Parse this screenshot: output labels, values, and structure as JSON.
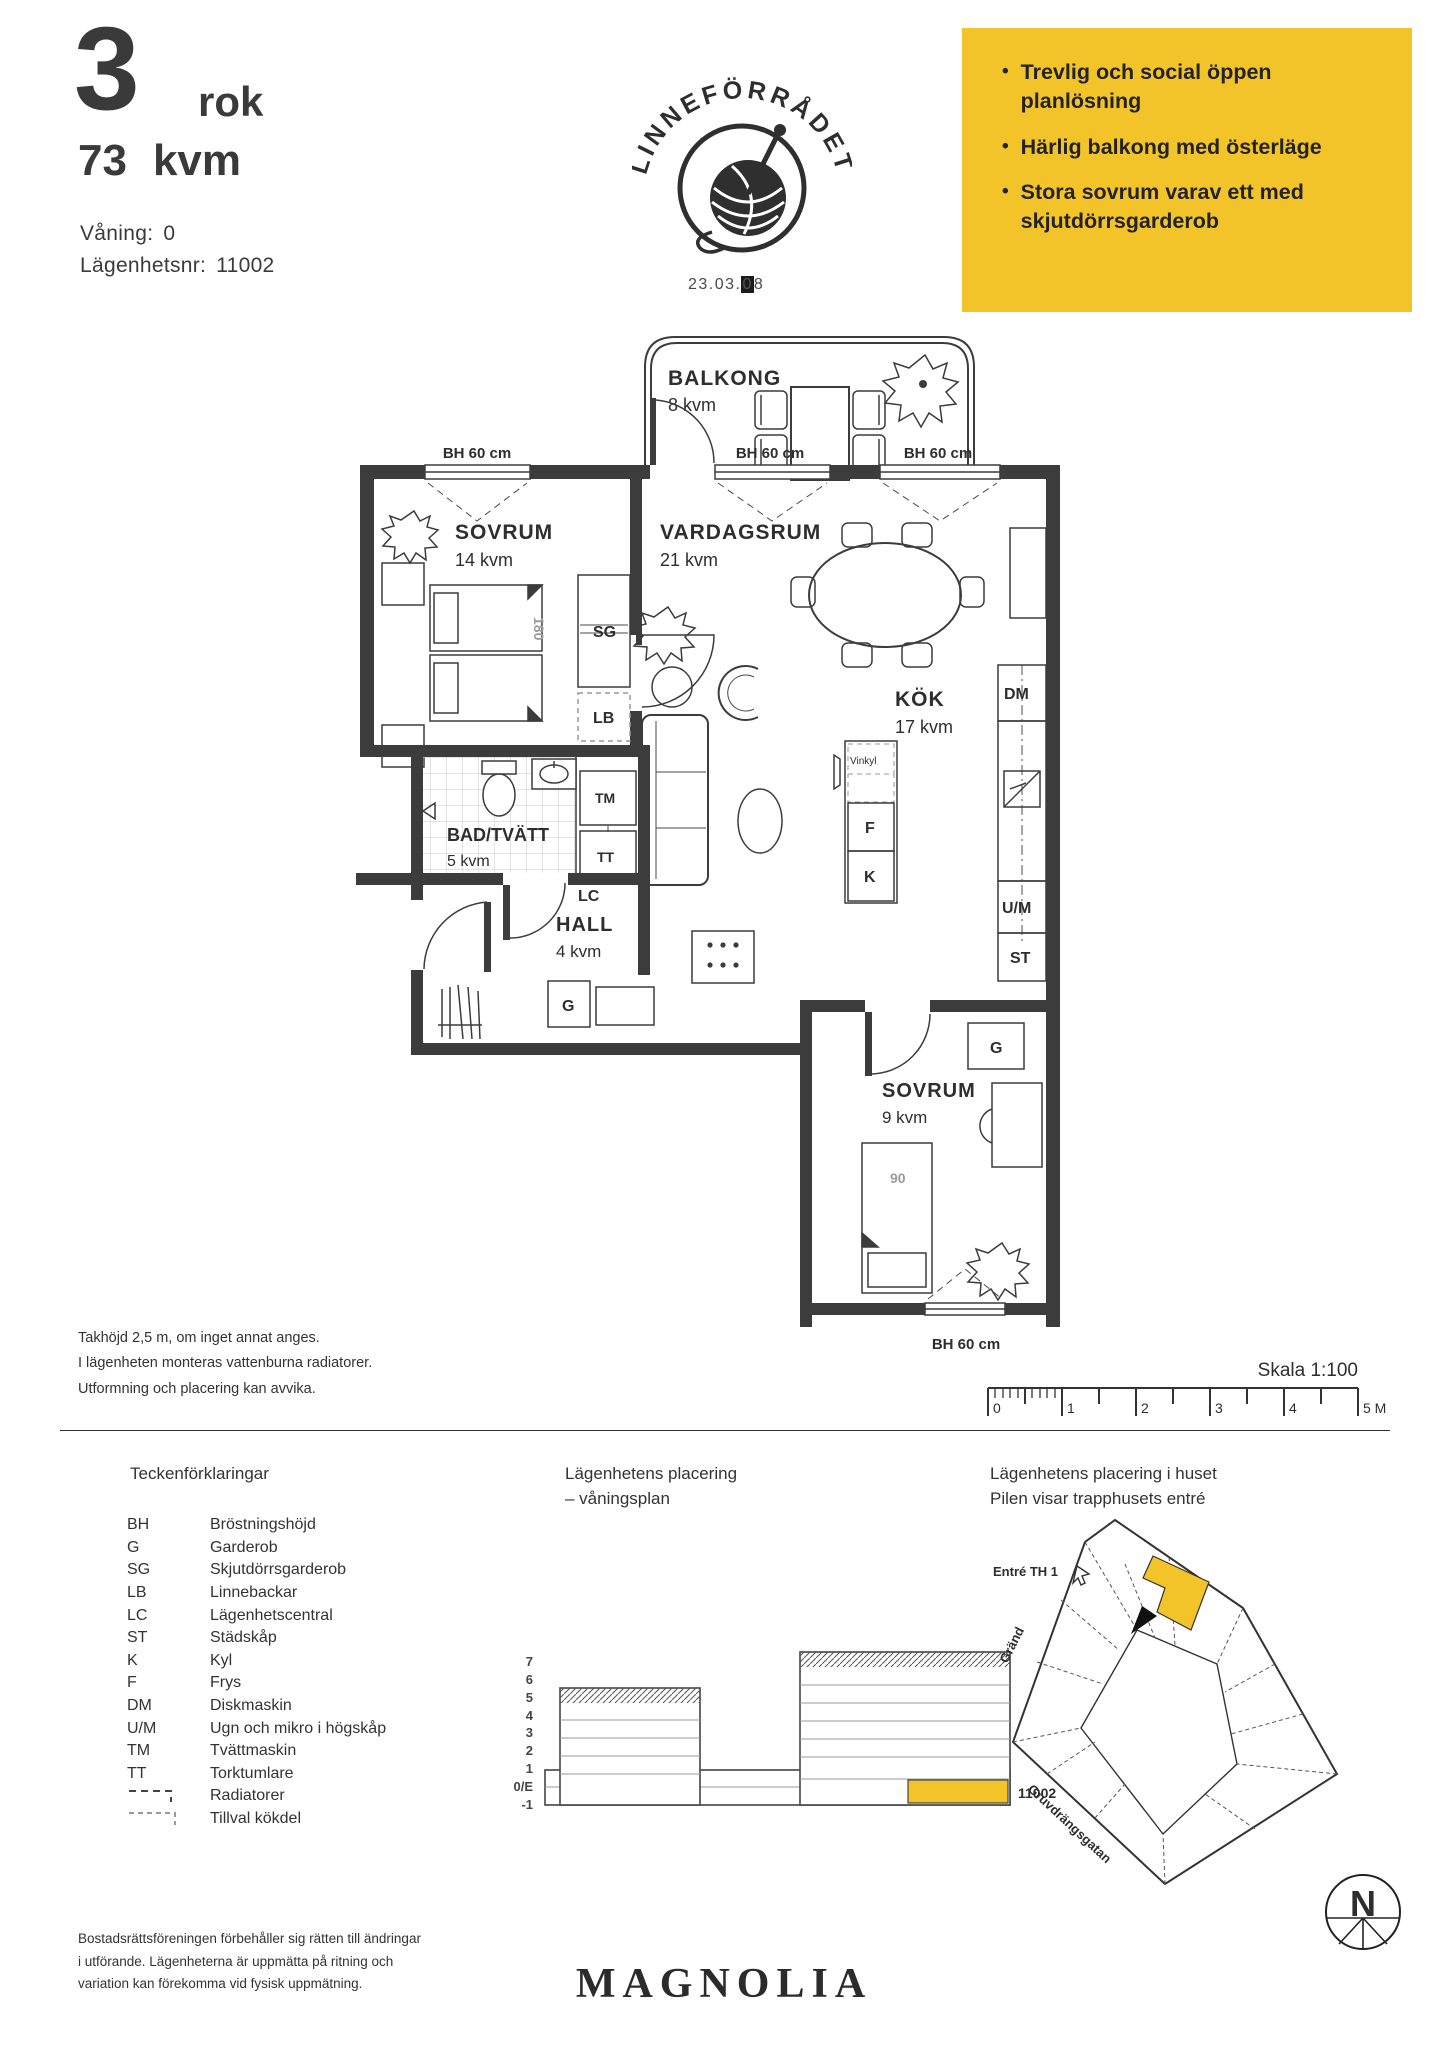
{
  "header": {
    "rooms_number": "3",
    "rooms_unit": "rok",
    "area_value": "73",
    "area_unit": "kvm",
    "floor_label": "Våning:",
    "floor_value": "0",
    "apartment_label": "Lägenhetsnr:",
    "apartment_value": "11002"
  },
  "logo": {
    "brand": "LINNEFÖRRÅDET",
    "date_prefix": "23.03.",
    "date_boxed": "0",
    "date_suffix": "8"
  },
  "highlights": {
    "bullet": "•",
    "bg": "#F3C32A",
    "items": [
      "Trevlig och social öppen planlösning",
      "Härlig balkong med österläge",
      "Stora sovrum varav ett med skjutdörrsgarderob"
    ]
  },
  "floorplan": {
    "balcony_name": "BALKONG",
    "balcony_area": "8 kvm",
    "bedroom1_name": "SOVRUM",
    "bedroom1_area": "14 kvm",
    "living_name": "VARDAGSRUM",
    "living_area": "21 kvm",
    "kitchen_name": "KÖK",
    "kitchen_area": "17 kvm",
    "bath_name": "BAD/TVÄTT",
    "bath_area": "5 kvm",
    "hall_name": "HALL",
    "hall_area": "4 kvm",
    "bedroom2_name": "SOVRUM",
    "bedroom2_area": "9 kvm",
    "window_height_label": "BH 60 cm",
    "bed_double_width": "180",
    "bed_single_width": "90",
    "wardrobe": "G",
    "sliding_wardrobe": "SG",
    "linen": "LB",
    "central": "LC",
    "cleaning": "ST",
    "fridge": "K",
    "freezer": "F",
    "dishwasher": "DM",
    "oven_micro": "U/M",
    "washer": "TM",
    "dryer": "TT",
    "wine_fridge": "Vinkyl"
  },
  "notes": {
    "lines": [
      "Takhöjd 2,5 m, om inget annat anges.",
      "I lägenheten monteras vattenburna radiatorer.",
      "Utformning och placering kan avvika."
    ]
  },
  "scalebar": {
    "title": "Skala 1:100",
    "ticks": [
      "0",
      "1",
      "2",
      "3",
      "4",
      "5 M"
    ]
  },
  "legend": {
    "title": "Teckenförklaringar",
    "items": [
      {
        "abbr": "BH",
        "label": "Bröstningshöjd"
      },
      {
        "abbr": "G",
        "label": "Garderob"
      },
      {
        "abbr": "SG",
        "label": "Skjutdörrsgarderob"
      },
      {
        "abbr": "LB",
        "label": "Linnebackar"
      },
      {
        "abbr": "LC",
        "label": "Lägenhetscentral"
      },
      {
        "abbr": "ST",
        "label": "Städskåp"
      },
      {
        "abbr": "K",
        "label": "Kyl"
      },
      {
        "abbr": "F",
        "label": "Frys"
      },
      {
        "abbr": "DM",
        "label": "Diskmaskin"
      },
      {
        "abbr": "U/M",
        "label": "Ugn och mikro i högskåp"
      },
      {
        "abbr": "TM",
        "label": "Tvättmaskin"
      },
      {
        "abbr": "TT",
        "label": "Torktumlare"
      },
      {
        "abbr": "",
        "label": "Radiatorer"
      },
      {
        "abbr": "",
        "label": "Tillval kökdel"
      }
    ]
  },
  "placement_floor": {
    "title_line1": "Lägenhetens placering",
    "title_line2": "– våningsplan",
    "floors": [
      "7",
      "6",
      "5",
      "4",
      "3",
      "2",
      "1",
      "0/E",
      "-1"
    ],
    "unit": "11002"
  },
  "placement_house": {
    "title_line1": "Lägenhetens placering i huset",
    "title_line2": "Pilen visar trapphusets entré",
    "entrance_label": "Entré TH 1",
    "street_left": "Gränd",
    "street_bottom": "Gruvdrängsgatan",
    "compass_letter": "N"
  },
  "footer": {
    "disclaimer_lines": [
      "Bostadsrättsföreningen förbehåller sig rätten till ändringar",
      "i utförande. Lägenheterna är uppmätta på ritning och",
      "variation kan förekomma vid fysisk uppmätning."
    ],
    "brand": "MAGNOLIA"
  },
  "colors": {
    "accent": "#F3C32A",
    "ink": "#3c3c3c"
  }
}
